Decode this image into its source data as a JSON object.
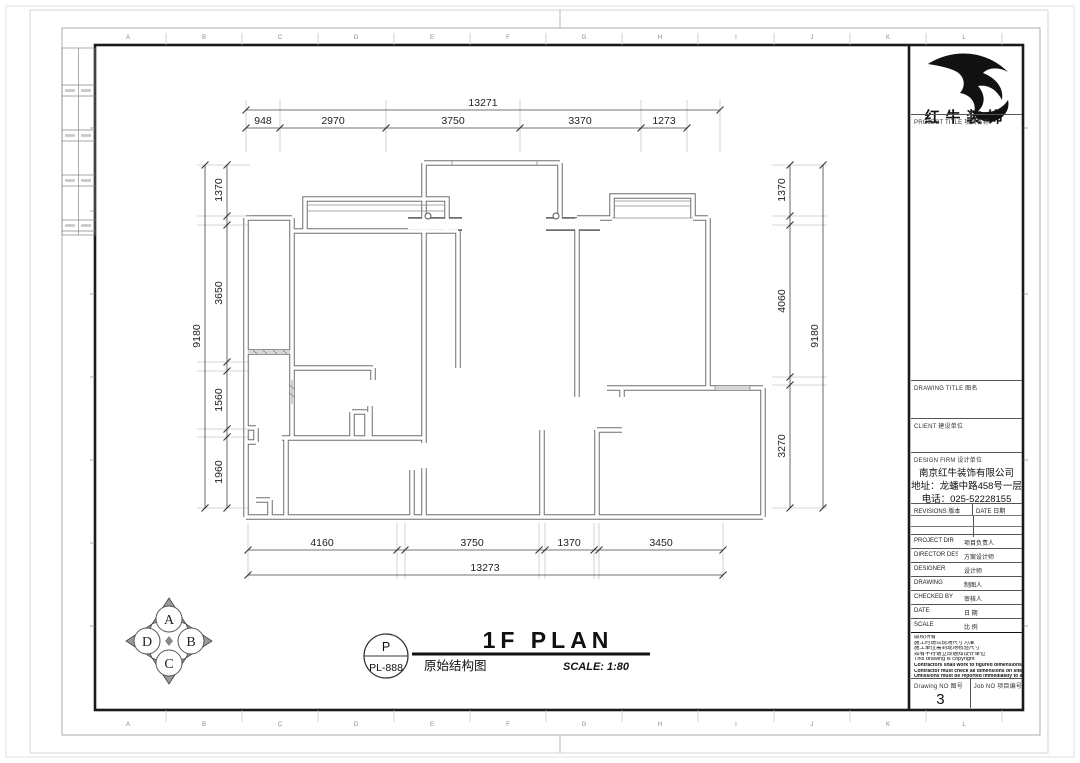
{
  "colors": {
    "frame": "#1a1a1a",
    "wall_line": "#6f6f6f",
    "dim_text": "#222222",
    "logo": "#111111"
  },
  "grid": {
    "letters": [
      "A",
      "B",
      "C",
      "D",
      "E",
      "F",
      "G",
      "H",
      "I",
      "J",
      "K",
      "L"
    ]
  },
  "plan": {
    "dimensions": {
      "top": {
        "total": "13271",
        "segments": [
          "948",
          "2970",
          "3750",
          "3370",
          "1273"
        ]
      },
      "bottom": {
        "total": "13273",
        "segments": [
          "4160",
          "3750",
          "1370",
          "3450"
        ]
      },
      "left": {
        "total": "9180",
        "segments": [
          "1370",
          "3650",
          "1560",
          "1960"
        ]
      },
      "right": {
        "total": "9180",
        "segments": [
          "1370",
          "4060",
          "3270"
        ]
      }
    }
  },
  "compass": {
    "labels": [
      "A",
      "B",
      "C",
      "D"
    ]
  },
  "title_bar": {
    "bubble_top": "P",
    "bubble_bottom": "PL-888",
    "title": "1F PLAN",
    "subtitle_cn": "原始结构图",
    "scale": "SCALE: 1:80"
  },
  "title_block": {
    "logo_text": "红牛装饰",
    "project_title_label": "PROJECT TITLE  项目名称",
    "drawing_title_label": "DRAWING TITLE  图名",
    "client_label": "CLIENT  建设单位",
    "design_firm_label": "DESIGN FIRM  设计单位",
    "company_name": "南京红牛装饰有限公司",
    "company_address": "地址：龙蟠中路458号一层",
    "company_phone": "电话：025-52228155",
    "revisions_label": "REVISIONS  版本",
    "date_col_label": "DATE  日期",
    "fields": [
      {
        "label": "PROJECT DIR",
        "cn": "项目负责人"
      },
      {
        "label": "DIRECTOR DESI",
        "cn": "方案设计师"
      },
      {
        "label": "DESIGNER",
        "cn": "设计师"
      },
      {
        "label": "DRAWING",
        "cn": "制图人"
      },
      {
        "label": "CHECKED BY",
        "cn": "审核人"
      },
      {
        "label": "DATE",
        "cn": "日 期"
      },
      {
        "label": "SCALE",
        "cn": "比 例"
      }
    ],
    "notes": [
      "版权所有",
      "施工时请以现场尺寸为准",
      "施工单位需到现场核验尺寸",
      "如有不符请立即通知设计单位",
      "This drawing is copyright",
      "Contractors shall work to figured dimensions only",
      "Contractor must check all dimensions on site",
      "Omissions must be reported immediately to architects"
    ],
    "drawing_no_label": "Drawing NO  图号",
    "drawing_no": "3",
    "job_no_label": "Job NO  项目编号"
  }
}
